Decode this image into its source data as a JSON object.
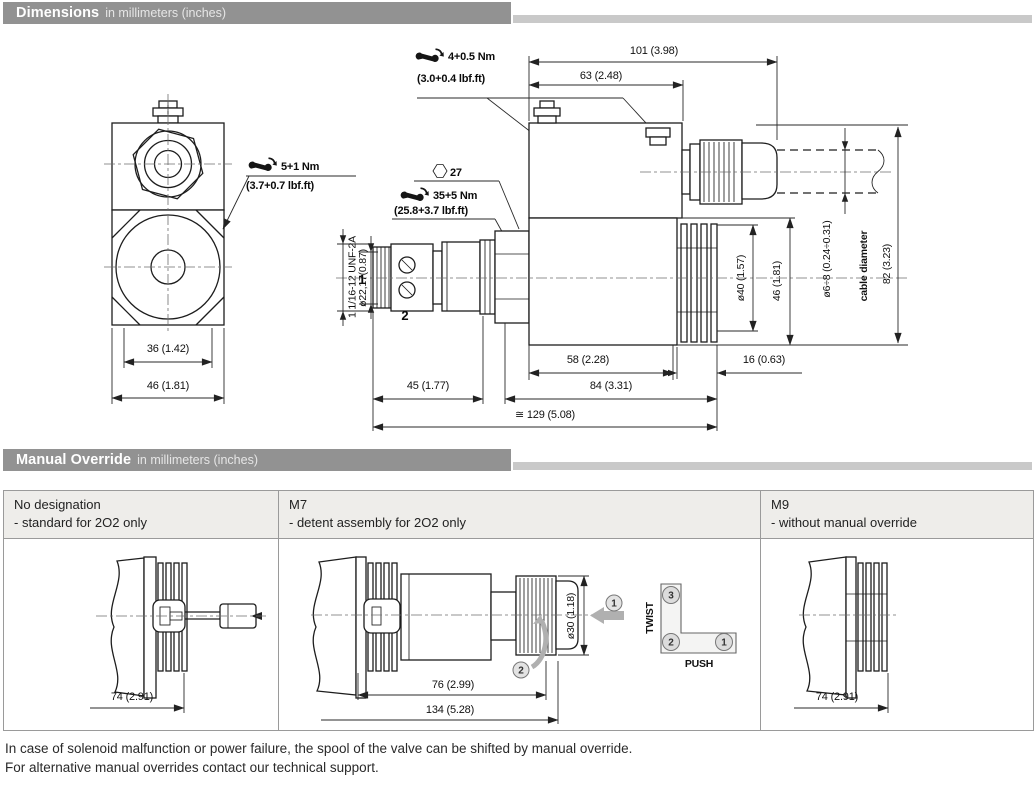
{
  "sections": [
    {
      "title": "Dimensions",
      "subtitle": "in millimeters (inches)"
    },
    {
      "title": "Manual Override",
      "subtitle": "in millimeters (inches)"
    }
  ],
  "dims": {
    "torque_top_nm": "4+0.5 Nm",
    "torque_top_lbf": "(3.0+0.4 lbf.ft)",
    "torque_left_nm": "5+1 Nm",
    "torque_left_lbf": "(3.7+0.7 lbf.ft)",
    "hex_size": "27",
    "torque_cart_nm": "35+5 Nm",
    "torque_cart_lbf": "(25.8+3.7 lbf.ft)",
    "thread": "1 1/16-12 UNF-2A",
    "cart_dia": "ø22,17(0.87)",
    "port_1": "1",
    "port_2": "2",
    "d101": "101 (3.98)",
    "d63": "63 (2.48)",
    "d36": "36 (1.42)",
    "d46l": "46 (1.81)",
    "d45": "45 (1.77)",
    "d58": "58 (2.28)",
    "d16": "16 (0.63)",
    "d84": "84 (3.31)",
    "d129": "≅ 129 (5.08)",
    "d40": "ø40 (1.57)",
    "d46r": "46 (1.81)",
    "dcable": "ø6÷8 (0.24÷0.31)",
    "cable_label": "cable diameter",
    "d82": "82 (3.23)"
  },
  "override": {
    "cols": [
      {
        "code": "No designation",
        "desc": "- standard for 2O2 only"
      },
      {
        "code": "M7",
        "desc": "- detent assembly for 2O2 only"
      },
      {
        "code": "M9",
        "desc": "- without manual override"
      }
    ],
    "cell1": {
      "d74": "74 (2.91)"
    },
    "cell2": {
      "d30": "ø30 (1.18)",
      "d76": "76 (2.99)",
      "d134": "134 (5.28)",
      "twist": "TWIST",
      "push": "PUSH",
      "n1": "1",
      "n2": "2",
      "n3": "3"
    },
    "cell3": {
      "d74": "74 (2.91)"
    }
  },
  "footer": {
    "line1": "In case of solenoid malfunction or power failure, the spool of the valve can be shifted by manual override.",
    "line2": "For alternative manual overrides contact our technical support."
  },
  "colors": {
    "header_bar": "#929292",
    "header_tail": "#c9c9c9",
    "table_header_bg": "#eeedea",
    "table_border": "#9a9a9a",
    "drawing_line": "#1d1d1d",
    "gray_accent": "#b0b0b0"
  }
}
